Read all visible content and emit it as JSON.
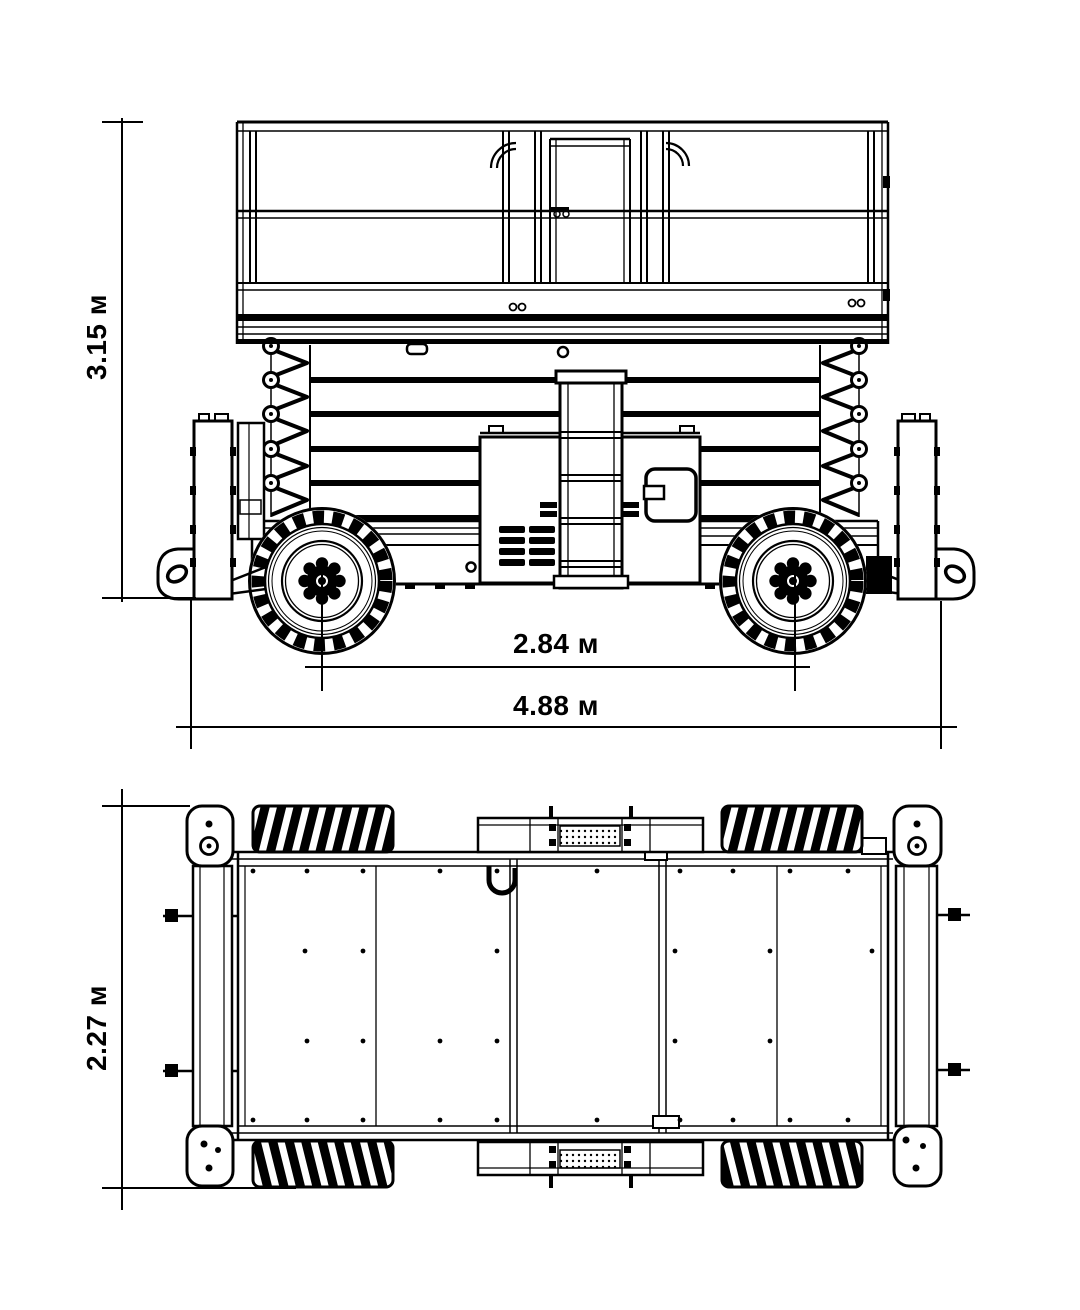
{
  "colors": {
    "line": "#000000",
    "background": "#ffffff"
  },
  "dimensions": {
    "side_view": {
      "height": "3.15 м",
      "wheelbase": "2.84 м",
      "length": "4.88 м"
    },
    "top_view": {
      "width": "2.27 м"
    }
  }
}
